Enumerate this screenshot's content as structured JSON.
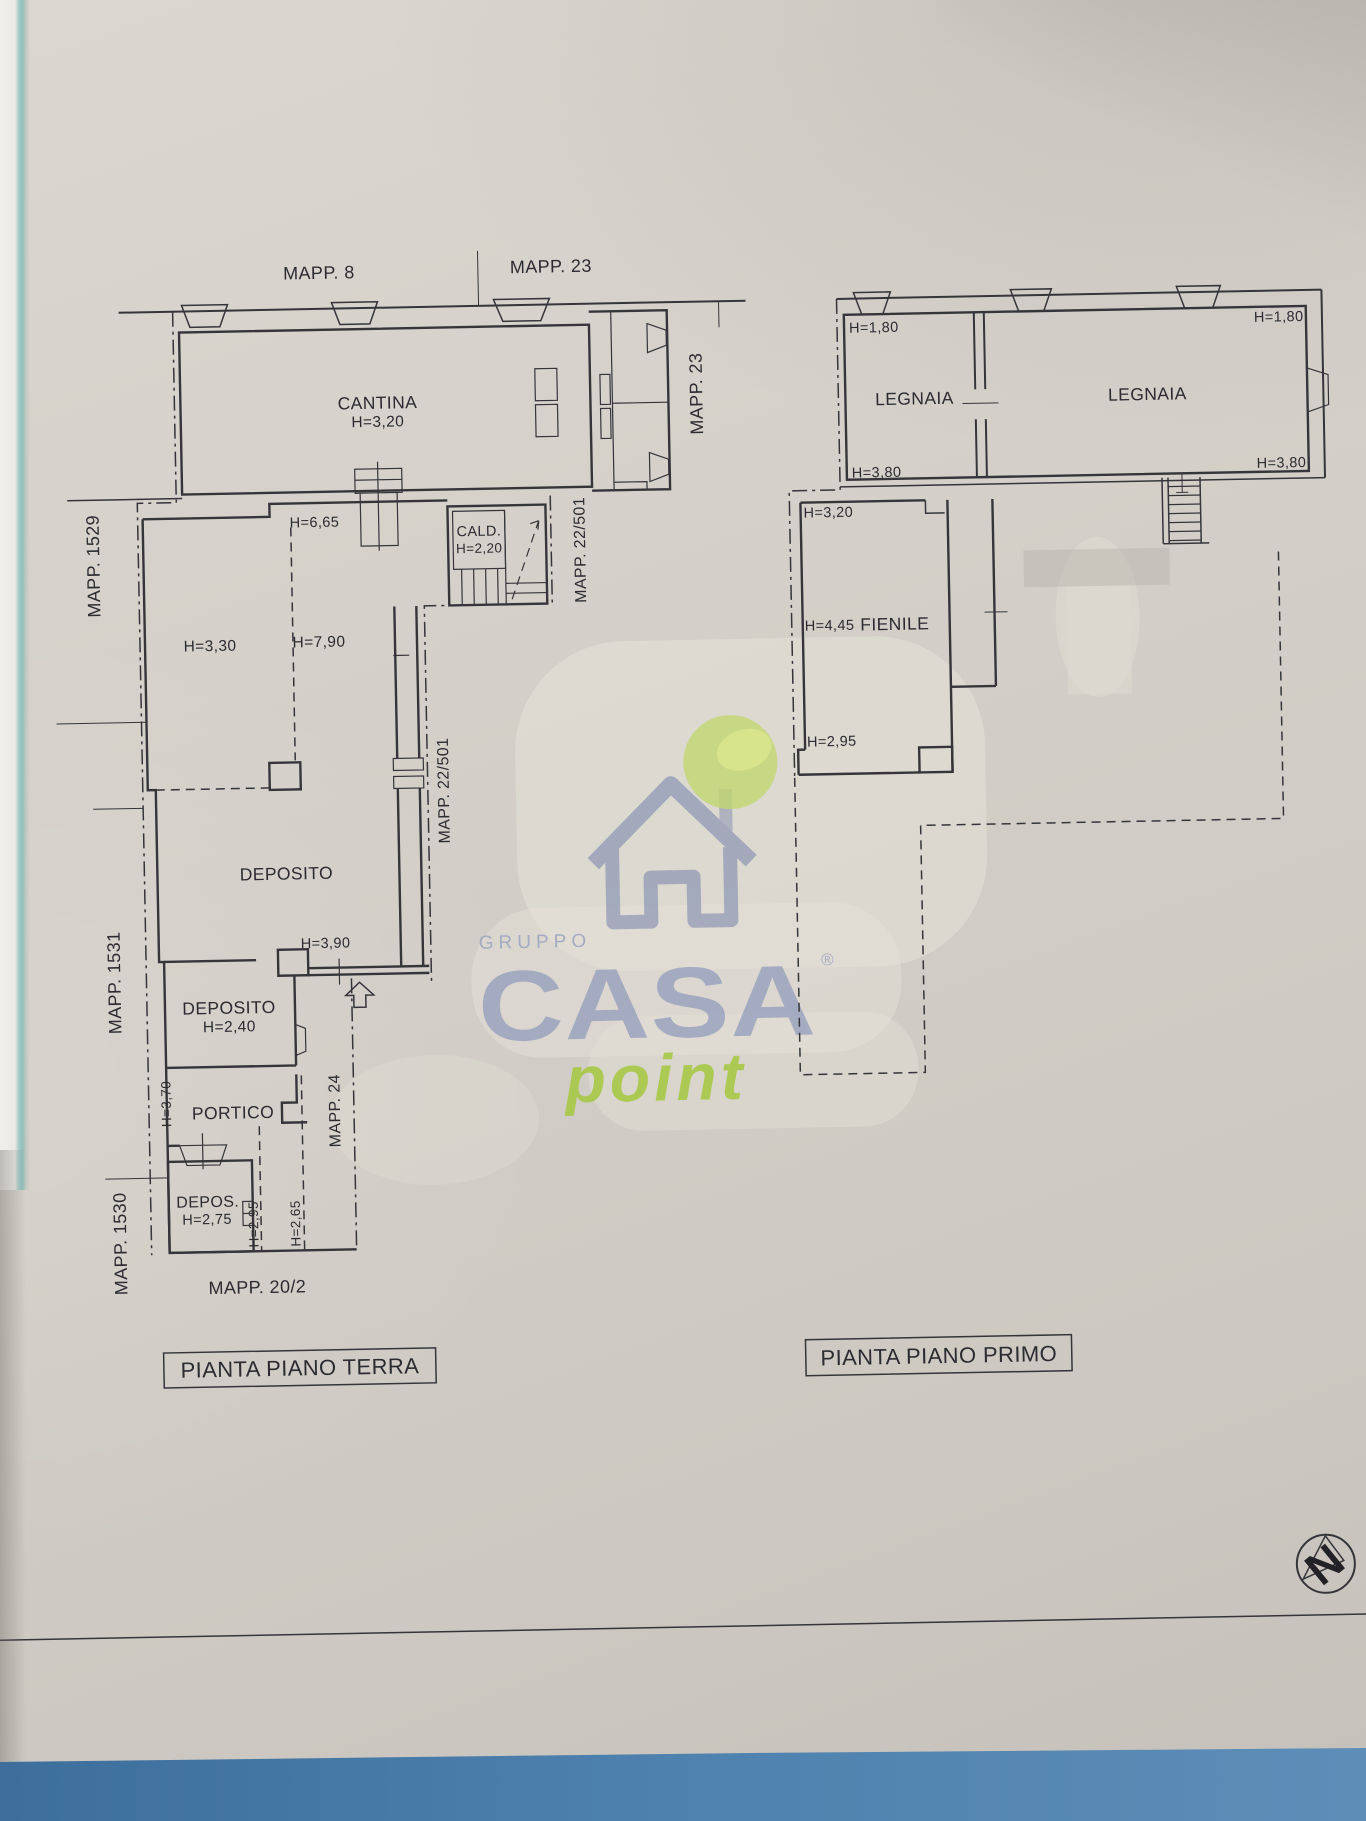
{
  "ground_floor": {
    "title": "PIANTA PIANO TERRA",
    "parcels": {
      "mapp_8": "MAPP. 8",
      "mapp_23_top": "MAPP. 23",
      "mapp_23_right": "MAPP. 23",
      "mapp_22_501_upper": "MAPP. 22/501",
      "mapp_22_501_lower": "MAPP. 22/501",
      "mapp_1529": "MAPP. 1529",
      "mapp_1531": "MAPP. 1531",
      "mapp_1530": "MAPP. 1530",
      "mapp_24": "MAPP. 24",
      "mapp_20_2": "MAPP. 20/2"
    },
    "rooms": {
      "cantina": {
        "name": "CANTINA",
        "height": "H=3,20"
      },
      "cald": {
        "name": "CALD.",
        "height": "H=2,20"
      },
      "deposito_main": {
        "name": "DEPOSITO"
      },
      "deposito_small": {
        "name": "DEPOSITO",
        "height": "H=2,40"
      },
      "portico": {
        "name": "PORTICO"
      },
      "deposito_tiny": {
        "name": "DEPOS.",
        "height": "H=2,75"
      }
    },
    "heights": {
      "h665": "H=6,65",
      "h330": "H=3,30",
      "h790": "H=7,90",
      "h390": "H=3,90",
      "h370": "H=3,70",
      "h295": "H=2,95",
      "h265": "H=2,65"
    }
  },
  "first_floor": {
    "title": "PIANTA PIANO PRIMO",
    "rooms": {
      "legnaia_left": {
        "name": "LEGNAIA",
        "height_top": "H=1,80",
        "height_bottom": "H=3,80"
      },
      "legnaia_right": {
        "name": "LEGNAIA",
        "height_top": "H=1,80",
        "height_bottom": "H=3,80"
      },
      "fienile": {
        "name": "FIENILE",
        "height_top": "H=3,20",
        "height_mid": "H=4,45",
        "height_bottom": "H=2,95"
      }
    }
  },
  "watermark": {
    "group_word": "GRUPPO",
    "brand": "CASA",
    "registered": "®",
    "suffix": "point"
  },
  "compass": {
    "north_letter": "N"
  },
  "colors": {
    "paper": "#d3cfc8",
    "ink": "#35353a",
    "watermark_blue": "#97a1be",
    "watermark_green": "#c9dc77",
    "point_green": "#a5c83e",
    "table_blue": "#4a7dab",
    "edge_teal": "#99c5c3"
  }
}
